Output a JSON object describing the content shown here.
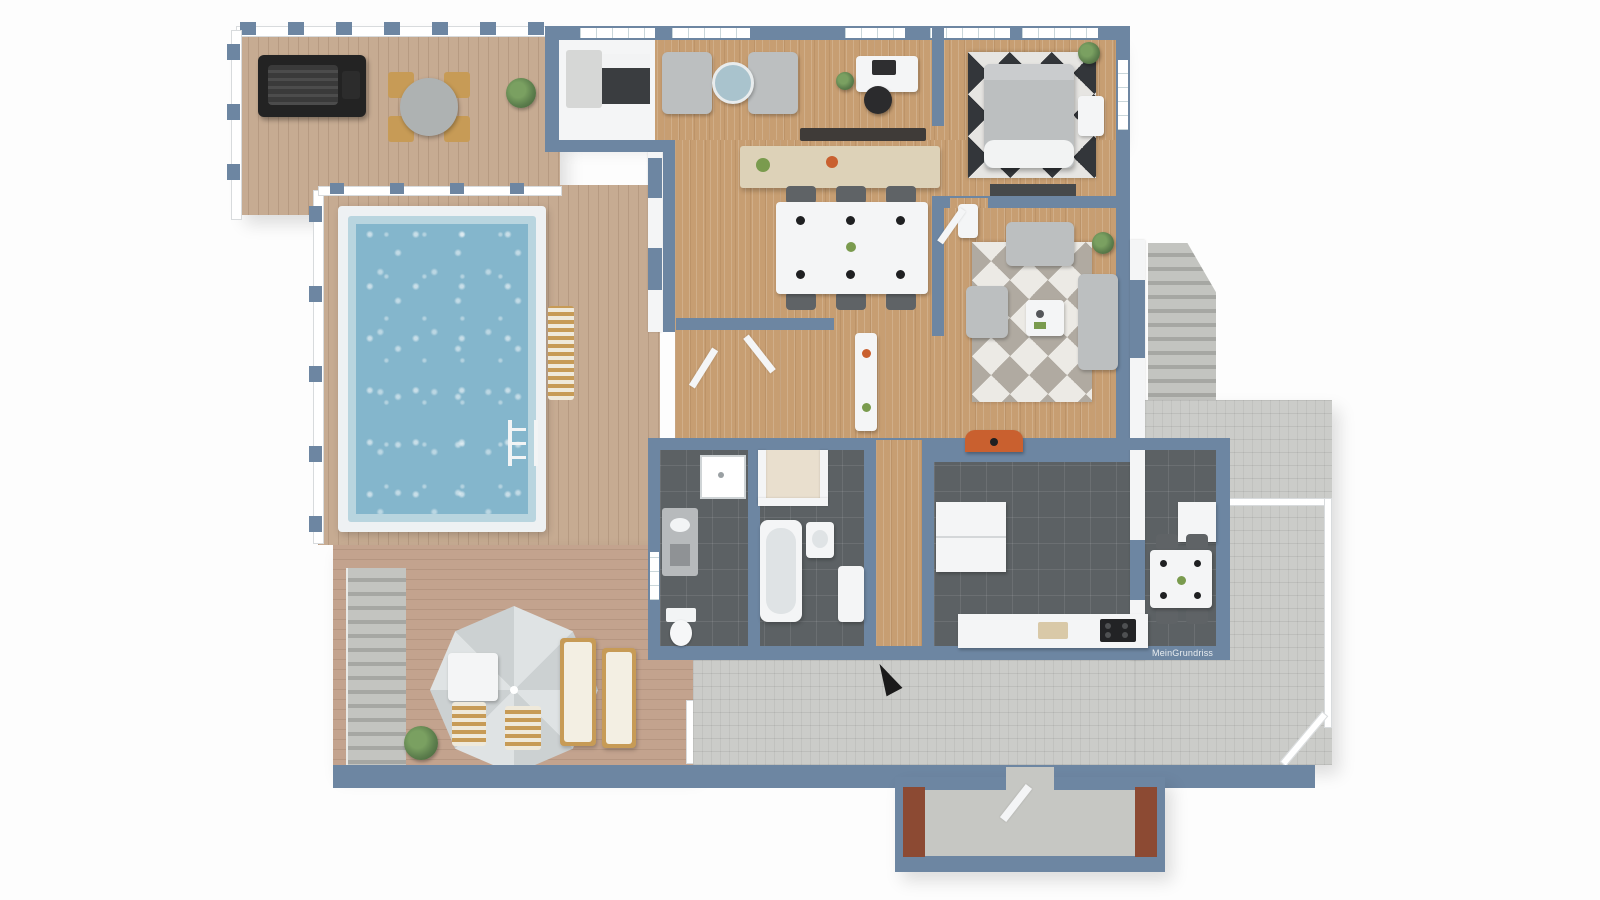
{
  "watermark": {
    "text": "MeinGrundriss"
  },
  "palette": {
    "wall": "#6d86a2",
    "white": "#f4f5f6",
    "deck": "#c6ab92",
    "deckWarm": "#c3a38e",
    "wood": "#c79e72",
    "tile": "#5c6164",
    "paver": "#cbccc9",
    "poolWater": "#84b6cc",
    "poolEdge": "#b9d5df",
    "coping": "#eef1f3",
    "steps": "#b9bab6",
    "brick": "#8c4a33",
    "plant": "#5d7f4d",
    "furnGray": "#bcbfc0",
    "chairDark": "#5f6366",
    "woodFurn": "#c79b56",
    "orange": "#c9602f",
    "concrete": "#c6c7c3",
    "beige": "#e9dfce",
    "sideboard": "#ddd2b8",
    "dark": "#3a3d40"
  },
  "scene": {
    "type": "3d-floorplan-top-view-render",
    "areas": [
      "balcony-deck",
      "pool-deck",
      "pool",
      "terrace",
      "outdoor-stairs",
      "sitting-area",
      "home-office",
      "storage-room",
      "dining-room",
      "bedroom",
      "living-room",
      "hallway",
      "bathroom-small",
      "bathroom-main",
      "utility-closet",
      "kitchen",
      "stone-patio",
      "patio-steps",
      "entry-porch"
    ],
    "objects": [
      "bbq-grill",
      "outdoor-dining-set",
      "deck-plant",
      "pool-ladder",
      "pool-lounger",
      "parasol",
      "side-table",
      "deck-chairs",
      "sun-loungers",
      "terrace-plant",
      "armchairs",
      "round-side-table",
      "office-desk",
      "office-chair",
      "dining-table",
      "dining-chairs",
      "sideboard",
      "wall-art",
      "double-bed",
      "bedroom-rug",
      "media-bench",
      "nightstand",
      "bedroom-plant",
      "sofa",
      "armchair",
      "coffee-table",
      "living-rug",
      "ladder-shelf",
      "fireplace-stove",
      "hall-cabinet",
      "shower",
      "vanity",
      "toilet",
      "bathtub",
      "washbasin",
      "kitchen-counter",
      "cooktop",
      "kitchen-table",
      "kitchen-chairs",
      "entrance-arrow",
      "entry-door",
      "patio-railing"
    ]
  }
}
